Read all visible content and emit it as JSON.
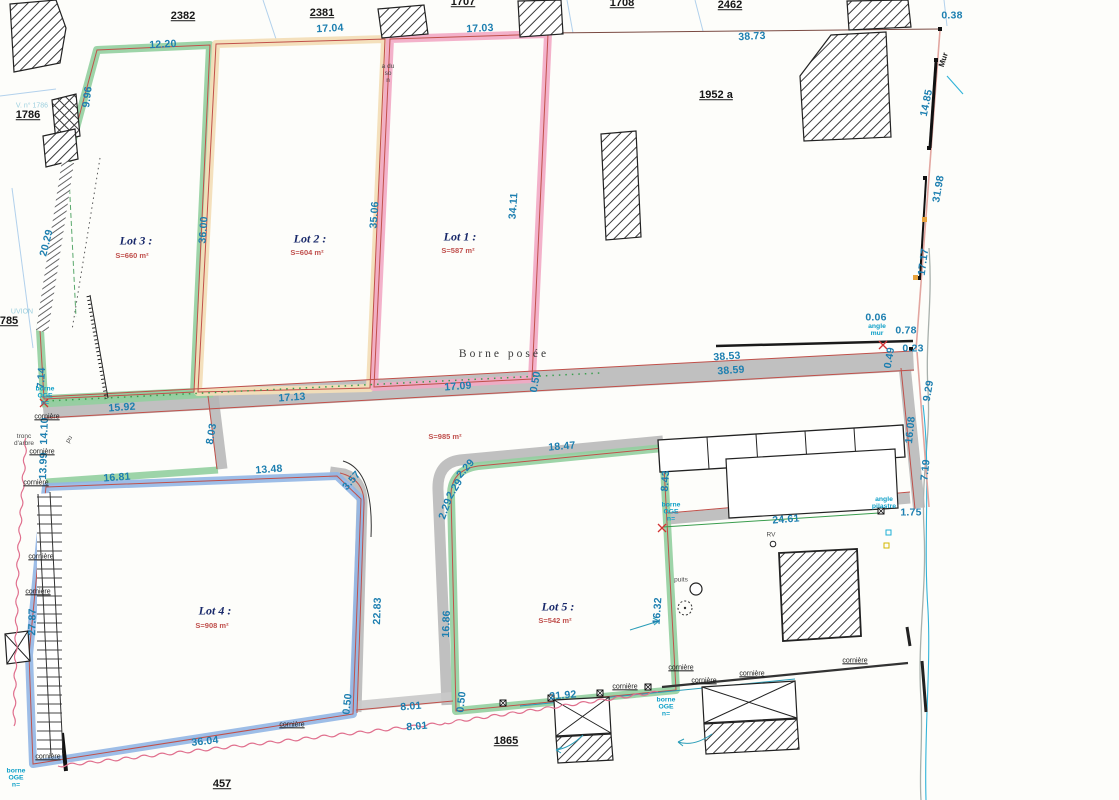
{
  "title": "Plan de division - Lots 1 à 5",
  "colors": {
    "lot_green": "#92cf9f",
    "lot_pink": "#f2a9c4",
    "lot_tan": "#f3deb8",
    "lot_blue": "#92b6e4",
    "road_gray": "#b5b5b5",
    "boundary_red": "#c0504a",
    "dimension_text": "#1d7fb0",
    "cyan_note": "#0fa0c8",
    "area_text_red": "#c0504d",
    "lot_label_navy": "#1a2a6b"
  },
  "parcels": {
    "p2382": "2382",
    "p2381": "2381",
    "p1707": "1707",
    "p1708": "1708",
    "p2462": "2462",
    "p1952": "1952 a",
    "p1786": "1786",
    "p785": "785",
    "p457": "457",
    "p1865": "1865"
  },
  "lots": {
    "lot1": {
      "label": "Lot 1 :",
      "area": "S=587 m²"
    },
    "lot2": {
      "label": "Lot 2 :",
      "area": "S=604 m²"
    },
    "lot3": {
      "label": "Lot 3 :",
      "area": "S=660 m²"
    },
    "lot4": {
      "label": "Lot 4 :",
      "area": "S=908 m²"
    },
    "lot5": {
      "label": "Lot 5 :",
      "area": "S=542 m²"
    },
    "road_area": "S=985 m²"
  },
  "measurements": {
    "m1220": "12.20",
    "m1704": "17.04",
    "m1703": "17.03",
    "m3873": "38.73",
    "m038": "0.38",
    "m996": "9.96",
    "m2029": "20.29",
    "m714": "7.14",
    "m1410": "14.10",
    "m1399": "13.99",
    "m2787": "27.87",
    "m3600": "36.00",
    "m3506": "35.06",
    "m3411": "34.11",
    "m1713": "17.13",
    "m1709": "17.09",
    "m050": "0.50",
    "m3853": "38.53",
    "m3859": "38.59",
    "m1592": "15.92",
    "m1681": "16.81",
    "m803": "8.03",
    "m1485": "14.85",
    "m3198": "31.98",
    "m1717": "17.17",
    "m006": "0.06",
    "m078": "0.78",
    "m023": "0.23",
    "m049": "0.49",
    "m929": "9.29",
    "m1608": "16.08",
    "m719": "7.19",
    "m175": "1.75",
    "m2461": "24.61",
    "m843": "8.43",
    "m1847": "18.47",
    "m229": "2.29",
    "m1348": "13.48",
    "m357": "3.57",
    "m2283": "22.83",
    "m1686": "16.86",
    "m1632": "16.32",
    "m801": "8.01",
    "m3604": "36.04",
    "m2192": "21.92"
  },
  "annotations": {
    "borne_posee": "Borne posée",
    "mur": "Mur",
    "angle_mur": "angle\nmur",
    "angle_pilastre": "angle\npilastre",
    "tronc_arbre": "tronc\nd'arbre",
    "corniere": "cornière",
    "borne_oge": "borne\nOGE\nn=",
    "puits": "puits",
    "rv": "RV",
    "pu": "pu",
    "note_lot1": "a du\nso\nn",
    "faint_1786": "V. n° 1786",
    "faint_uvion": "UVION"
  }
}
